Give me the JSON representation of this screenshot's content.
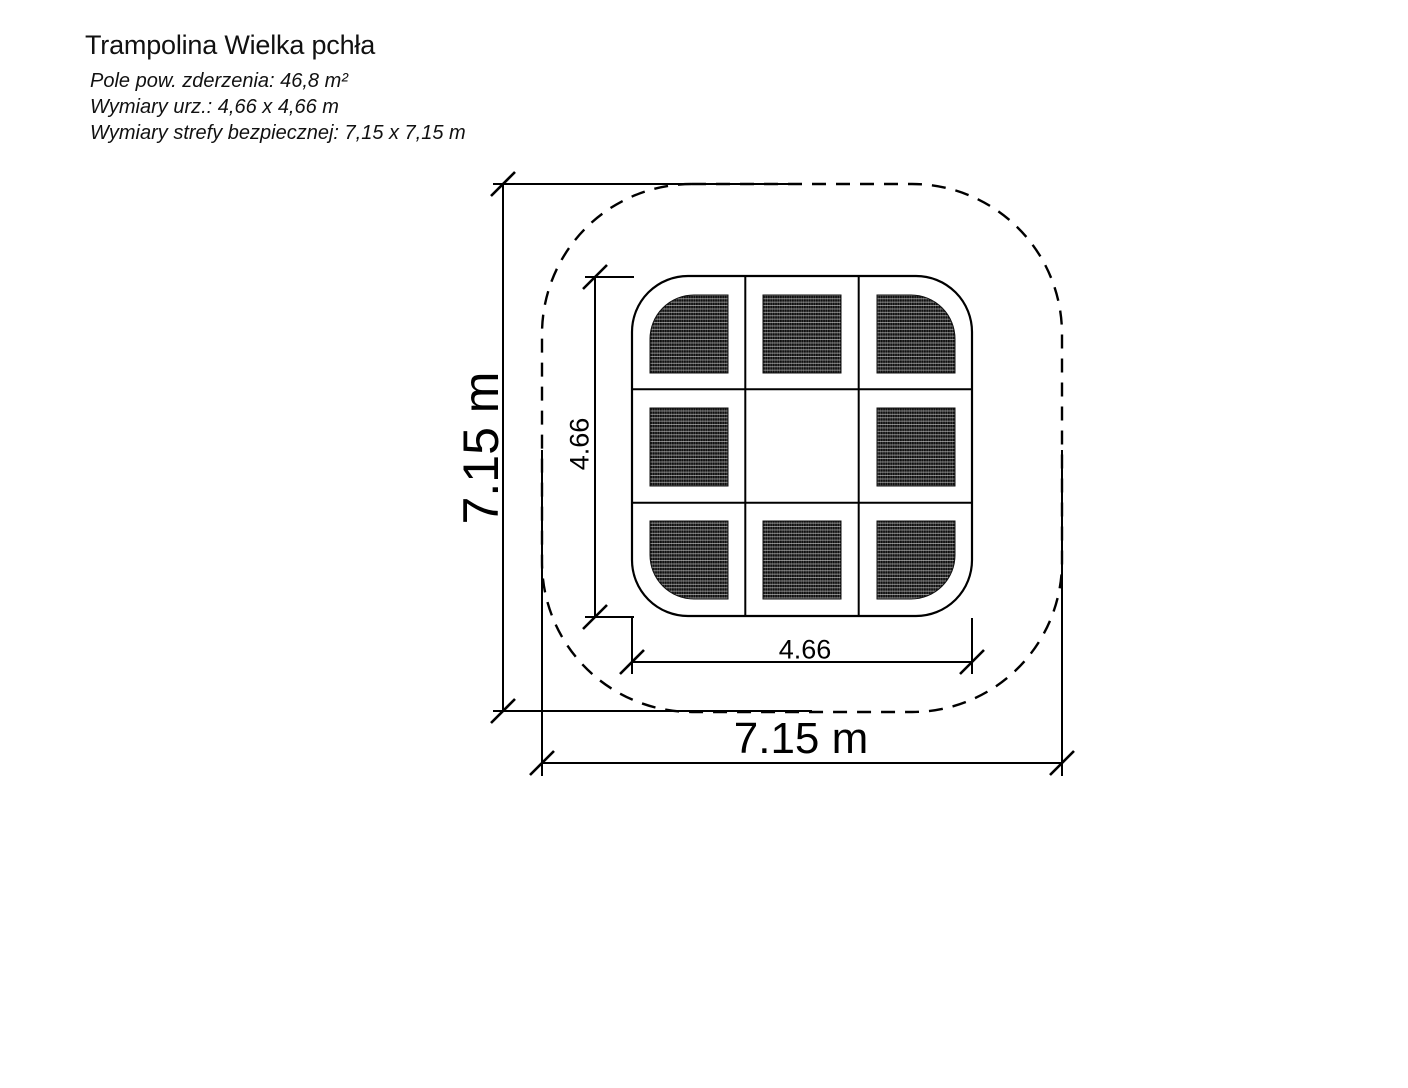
{
  "title": "Trampolina Wielka pchła",
  "specs": {
    "area": "Pole pow. zderzenia: 46,8 m²",
    "device": "Wymiary urz.: 4,66 x 4,66 m",
    "safety": "Wymiary strefy bezpiecznej: 7,15 x 7,15 m"
  },
  "plan": {
    "safety_zone_height_label": "7.15 m",
    "safety_zone_width_label": "7.15 m",
    "device_height_label": "4.66",
    "device_width_label": "4.66"
  },
  "colors": {
    "line": "#000000",
    "background": "#ffffff",
    "mat_dark": "#0f0f0f"
  }
}
